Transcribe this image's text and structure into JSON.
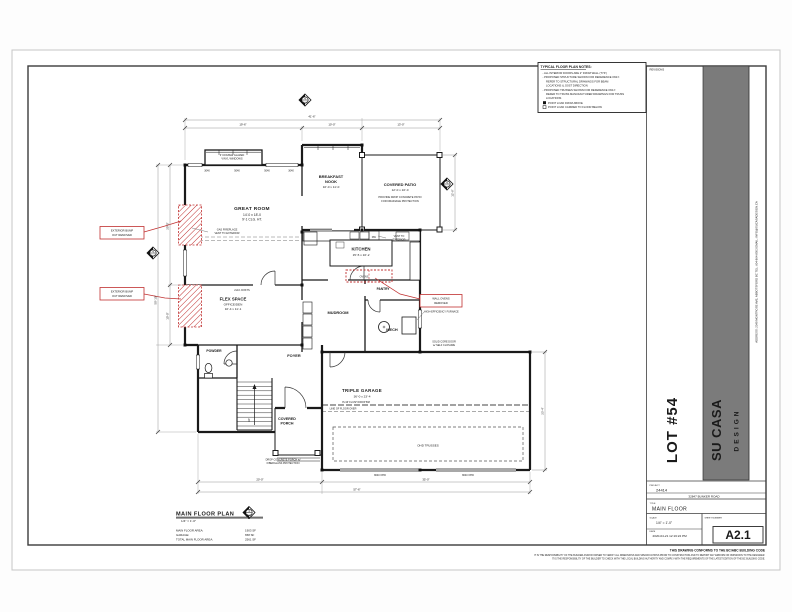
{
  "colors": {
    "annotation_red": "#c03030",
    "band_gray": "#7b7b7b",
    "paper": "#ffffff",
    "line_dark": "#1a1a1a"
  },
  "title_block": {
    "revisions_label": "REVISIONS",
    "lot_label": "LOT #54",
    "brand": {
      "name": "SU CASA",
      "sub": "DESIGN",
      "contact": "ADDRESS: 2349 MONTROSE AVE, ABBOTSFORD BC        TEL: 604-864-8503        EMAIL: INFO@SUCASADESIGN.CA"
    },
    "project": {
      "label": "PROJECT",
      "value": "24414"
    },
    "site_address": "32847 BUNKER ROAD",
    "title": {
      "label": "TITLE",
      "value": "MAIN FLOOR"
    },
    "scale": {
      "label": "SCALE",
      "value": "1/4\" = 1'-0\""
    },
    "date": {
      "label": "DATE",
      "value": "2020-04-21 12:16:22 PM"
    },
    "sheet": {
      "label": "SHEET NUMBER",
      "value": "A2.1"
    },
    "conformance_note": "THIS DRAWING CONFORMS TO THE BC/ABC BUILDING CODE",
    "disclaimer_lines": [
      "IT IS THE RESPONSIBILITY OF THE BUILDER AND/OR OWNER TO VERIFY ALL DIMENSIONS AND SPECIFICATIONS PRIOR TO CONSTRUCTION AND TO REPORT ANY ERRORS OR OMISSIONS TO THE DESIGNER.",
      "IT IS THE RESPONSIBILITY OF THE BUILDER TO CHECK WITH THE LOCAL BUILDING AUTHORITY AND COMPLY WITH THE REQUIREMENTS OF THE LATEST EDITION OF THE BC BUILDING CODE."
    ]
  },
  "notes_box": {
    "title": "TYPICAL FLOOR PLAN NOTES:",
    "lines": [
      "-  ALL INTERIOR DOORS ARE 2\" FROM WALL (TYP.)",
      "-  PROPOSED STRUCTURE SHOWN FOR REFERENCE ONLY.",
      "REFER TO STRUCTURAL DRAWINGS FOR BEAM",
      "LOCATIONS & JOIST DIRECTION",
      "-  PROPOSED TRUSSES SHOWN FOR REFERENCE ONLY.",
      "REFER TO TRUSS MANUFACTURER DRAWINGS FOR TRUSS",
      "LOCATIONS",
      "POINT LOAD FROM ABOVE",
      "POINT LOAD CARRIED TO FLOOR BELOW"
    ]
  },
  "plan": {
    "rooms": {
      "great_room": {
        "name": "GREAT ROOM",
        "size": "14'-0 x 18'-0",
        "ceiling": "9'-1 CLG. HT."
      },
      "breakfast_nook": {
        "name_line1": "BREAKFAST",
        "name_line2": "NOOK",
        "size": "10'-0 x 11'-0"
      },
      "covered_patio": {
        "name": "COVERED PATIO",
        "size": "12'-0 x 10'-0",
        "note_line1": "PROVIDE DROP CONCRETE PATIO",
        "note_line2": "FOR DRAINAGE PROTECTION"
      },
      "kitchen": {
        "name": "KITCHEN",
        "size": "15'-5 x 10'-2"
      },
      "flex_space": {
        "name": "FLEX SPACE",
        "sub": "OFFICE/DEN",
        "size": "10'-4 x 11'-1"
      },
      "mudroom": {
        "name": "MUDROOM"
      },
      "pantry": {
        "name": "PANTRY"
      },
      "mech": {
        "name": "MECH"
      },
      "powder": {
        "name": "POWDER"
      },
      "foyer": {
        "name": "FOYER"
      },
      "triple_garage": {
        "name": "TRIPLE GARAGE",
        "size": "36'-0 x 23'-4"
      },
      "covered_porch": {
        "name_line1": "COVERED",
        "name_line2": "PORCH"
      },
      "stairs": {
        "label": "UP"
      }
    },
    "notes": {
      "windows_line1": "3' DOUBLE GLAZED",
      "windows_line2": "VINYL WINDOWS",
      "fireplace_line1": "GAS FIREPLACE",
      "fireplace_line2": "VENT TO EXTERIOR",
      "joists": "2x10 JOISTS",
      "vent_line1": "VENT TO",
      "vent_line2": "EXTERIOR",
      "dw": "DW",
      "drop_beam": "8'x16' FLUSH DROP BM",
      "floor_over": "LINE OF FLOOR OVER",
      "ohd_trusses": "OHD TRUSSES",
      "porch_conc_line1": "DROP CONCRETE PORCH w/",
      "porch_conc_line2": "FIBERGLASS PROTECTION",
      "solid_core_line1": "SOLID CORE DOOR",
      "solid_core_line2": "w/ SELF CLOSURE",
      "furnace": "HIGH-EFFICIENCY FURNACE"
    },
    "red_annotations": {
      "bump1_line1": "EXTERIOR BUMP",
      "bump1_line2": "OUT REMOVED",
      "bump2_line1": "EXTERIOR BUMP",
      "bump2_line2": "OUT REMOVED",
      "ovens_line1": "WALL OVENS",
      "ovens_line2": "REMOVED",
      "ovens_tag": "OVENS"
    },
    "window_tags": [
      "3040",
      "5040",
      "5040",
      "3040"
    ],
    "garage_door_tags": [
      "8040 OHD",
      "8040 OHD"
    ],
    "dimensions": {
      "top_overall": "41'-6\"",
      "top_1": "19'-6\"",
      "top_2": "10'-0\"",
      "top_3": "13'-0\"",
      "left_overall": "50'-10\"",
      "left_1": "20'-0\"",
      "left_2": "10'-0\"",
      "right_patio": "12'-6\"",
      "right_garage": "23'-4\"",
      "bottom_1": "20'-0\"",
      "bottom_2": "35'-0\"",
      "bottom_overall": "57'-6\""
    },
    "marker_ref": {
      "number": "4",
      "sheet": "A4.0"
    },
    "plan_title": {
      "heading": "MAIN FLOOR PLAN",
      "scale": "1/4\" = 1'-0\"",
      "rows": [
        {
          "label": "MAIN FLOOR AREA:",
          "value": "1903 SF"
        },
        {
          "label": "GARAGE:",
          "value": "658 SF"
        },
        {
          "label": "TOTAL MAIN FLOOR AREA:",
          "value": "2561 SF"
        }
      ]
    }
  }
}
